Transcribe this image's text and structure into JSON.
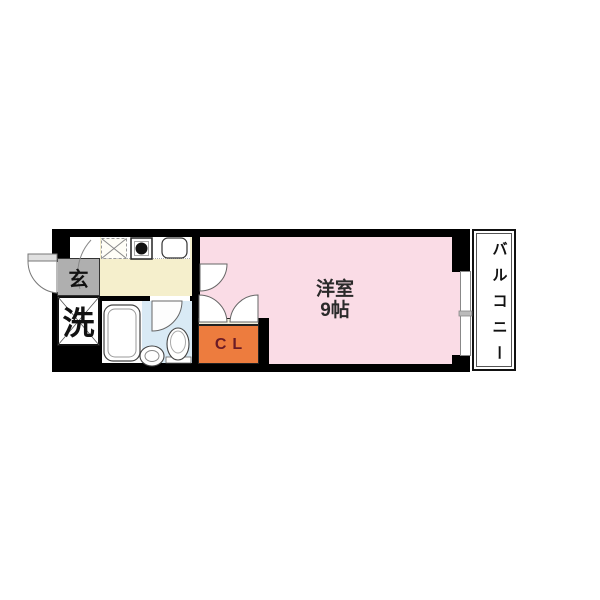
{
  "floorplan": {
    "labels": {
      "entrance": "玄",
      "laundry": "洗",
      "closet": "CL",
      "room_name": "洋室",
      "room_size": "9帖",
      "balcony": "バルコニー",
      "balcony_chars": [
        "バ",
        "ル",
        "コ",
        "ニ",
        "ー"
      ]
    },
    "colors": {
      "wall": "#000000",
      "room_pink": "#FADCE6",
      "kitchen_cream": "#F5EFCC",
      "bath_blue": "#D9EAF5",
      "closet_orange": "#ED7C3E",
      "closet_text": "#6B1B26",
      "entrance_gray": "#AFAFAF"
    },
    "fixtures": {
      "kitchen": [
        "refrigerator-space",
        "stove",
        "sink"
      ],
      "bathroom": [
        "bathtub",
        "wash-basin",
        "toilet"
      ],
      "doors": [
        "entrance-door",
        "room-door",
        "bathroom-door",
        "closet-double-doors"
      ],
      "window": "balcony-window"
    }
  }
}
